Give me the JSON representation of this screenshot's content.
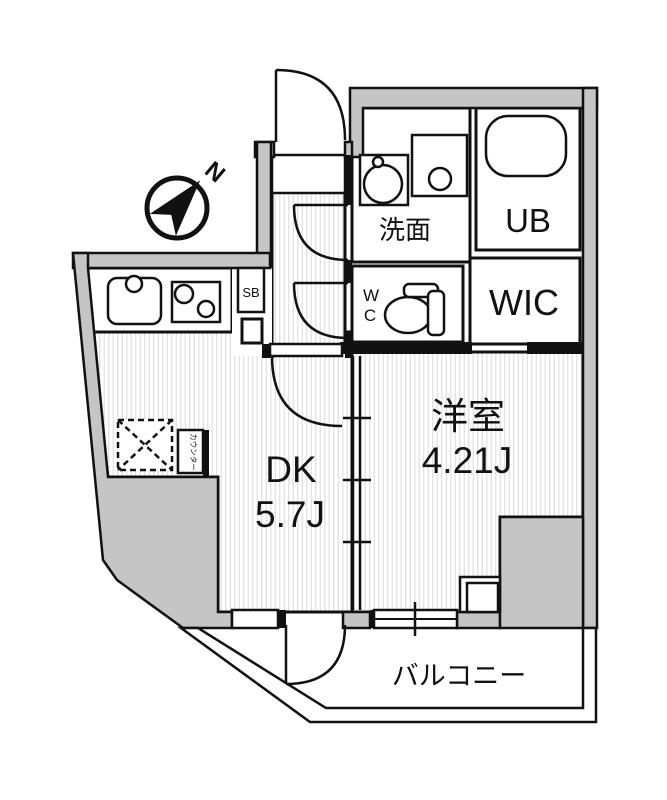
{
  "page": {
    "background": "#ffffff"
  },
  "plan": {
    "type": "apartment-floor-plan",
    "compass": {
      "north_label": "N"
    },
    "labels": {
      "dk_name": "DK",
      "dk_size": "5.7J",
      "western_room_name": "洋室",
      "western_room_size": "4.21J",
      "washroom": "洗面",
      "unit_bath": "UB",
      "walk_in_closet": "WIC",
      "toilet_line1": "W",
      "toilet_line2": "C",
      "shoe_box": "SB",
      "counter": "カウンター",
      "balcony": "バルコニー"
    },
    "colors": {
      "wall_fill": "#c5c5c5",
      "line": "#111111",
      "floor_stripe": "#dcdcdc"
    }
  }
}
